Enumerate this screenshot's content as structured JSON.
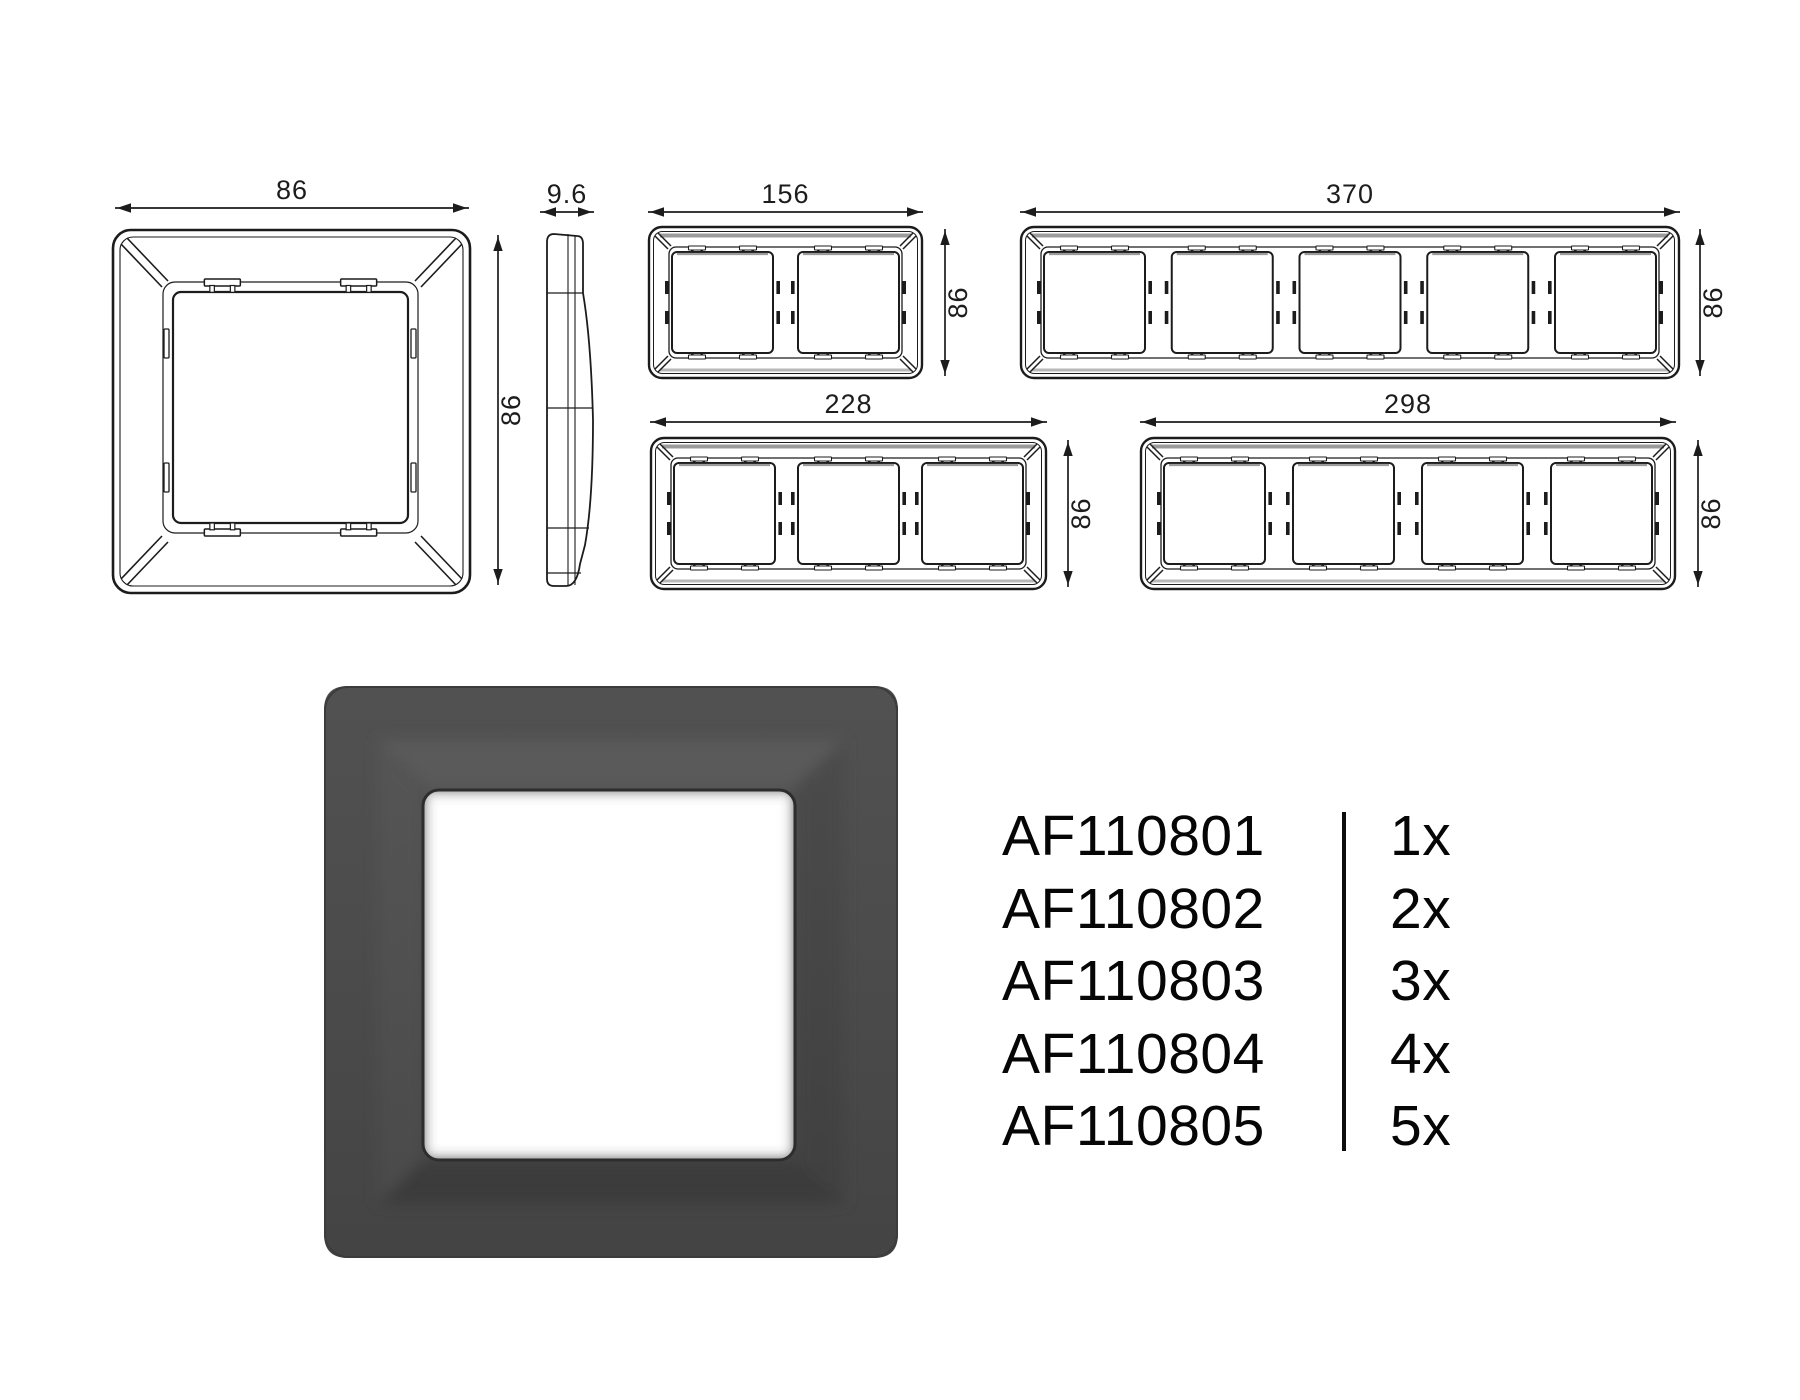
{
  "colors": {
    "background": "#ffffff",
    "line": "#1c1c1c",
    "shade": "#9b9b9b",
    "shade_light": "#b8b8b8",
    "render_frame": "#484848",
    "render_opening": "#ffffff"
  },
  "drawings": {
    "front_view": {
      "width_label": "86",
      "height_label": "86"
    },
    "side_view": {
      "depth_label": "9.6"
    },
    "multi_frames": [
      {
        "gangs": 2,
        "width_label": "156",
        "height_label": "86"
      },
      {
        "gangs": 5,
        "width_label": "370",
        "height_label": "86"
      },
      {
        "gangs": 3,
        "width_label": "228",
        "height_label": "86"
      },
      {
        "gangs": 4,
        "width_label": "298",
        "height_label": "86"
      }
    ]
  },
  "product_table": {
    "rows": [
      {
        "code": "AF110801",
        "quantity": "1x"
      },
      {
        "code": "AF110802",
        "quantity": "2x"
      },
      {
        "code": "AF110803",
        "quantity": "3x"
      },
      {
        "code": "AF110804",
        "quantity": "4x"
      },
      {
        "code": "AF110805",
        "quantity": "5x"
      }
    ]
  }
}
